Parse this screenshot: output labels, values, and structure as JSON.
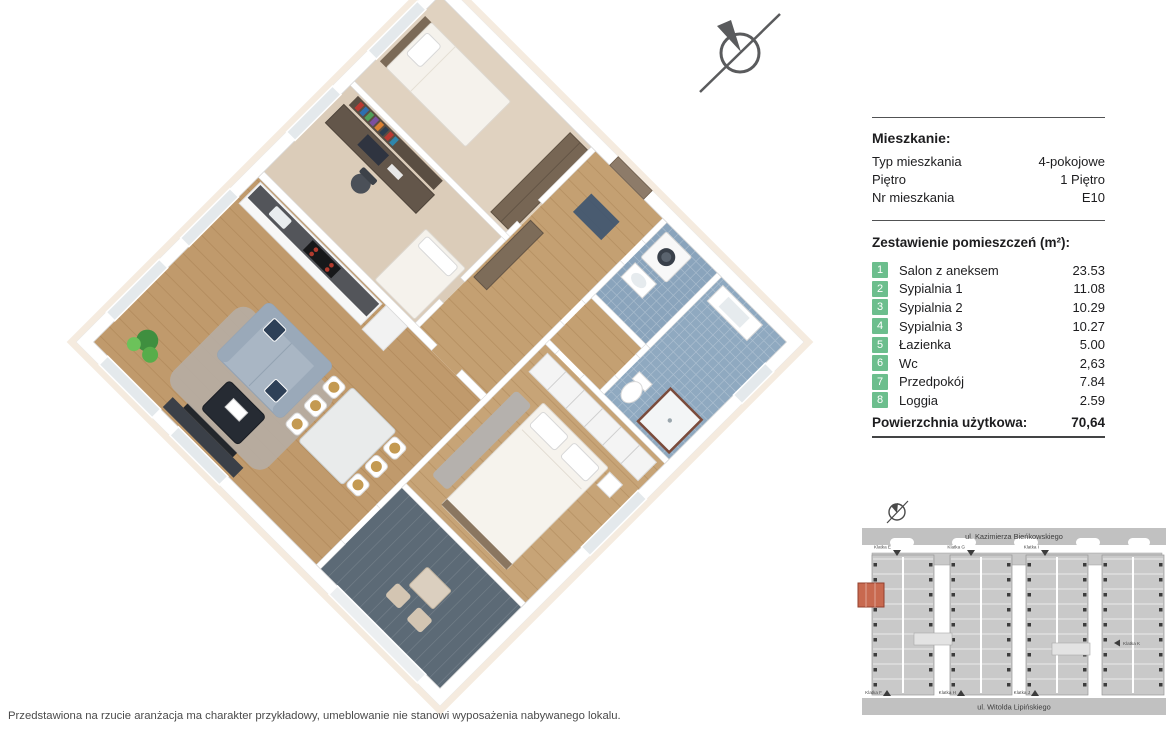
{
  "apartment_info": {
    "title": "Mieszkanie:",
    "rows": [
      {
        "label": "Typ mieszkania",
        "value": "4-pokojowe"
      },
      {
        "label": "Piętro",
        "value": "1 Piętro"
      },
      {
        "label": "Nr mieszkania",
        "value": "E10"
      }
    ]
  },
  "room_summary": {
    "title": "Zestawienie pomieszczeń (m²):",
    "badge_color": "#6cbe8d",
    "rooms": [
      {
        "num": "1",
        "name": "Salon z aneksem",
        "area": "23.53"
      },
      {
        "num": "2",
        "name": "Sypialnia 1",
        "area": "11.08"
      },
      {
        "num": "3",
        "name": "Sypialnia 2",
        "area": "10.29"
      },
      {
        "num": "4",
        "name": "Sypialnia 3",
        "area": "10.27"
      },
      {
        "num": "5",
        "name": "Łazienka",
        "area": "5.00"
      },
      {
        "num": "6",
        "name": "Wc",
        "area": "2,63"
      },
      {
        "num": "7",
        "name": "Przedpokój",
        "area": "7.84"
      },
      {
        "num": "8",
        "name": "Loggia",
        "area": "2.59"
      }
    ],
    "total_label": "Powierzchnia użytkowa:",
    "total_value": "70,64"
  },
  "floor_plan": {
    "compass": "north-arrow",
    "colors": {
      "wood_floor": "#c09a6c",
      "hall_floor": "#c4a072",
      "bedroom1_floor": "#c7a477",
      "carpet_a": "#e0d2c0",
      "carpet_b": "#dbccb9",
      "tile_wc": "#8aa4bc",
      "tile_bath": "#8fa9c0",
      "loggia_floor": "#5c6a76",
      "entrance_door": "#8d7b69"
    }
  },
  "site_map": {
    "street_top": "ul. Kazimierza Bieńkowskiego",
    "street_bottom": "ul. Witolda Lipińskiego",
    "highlight_color": "#c8694f",
    "klatka": {
      "top1": "Klatka E",
      "top2": "Klatka G",
      "top3": "Klatka I",
      "bottom1": "Klatka F",
      "bottom2": "Klatka H",
      "bottom3": "Klatka J",
      "right": "Klatka K"
    }
  },
  "footer": {
    "disclaimer": "Przedstawiona na rzucie aranżacja ma charakter przykładowy, umeblowanie nie stanowi wyposażenia nabywanego lokalu."
  }
}
